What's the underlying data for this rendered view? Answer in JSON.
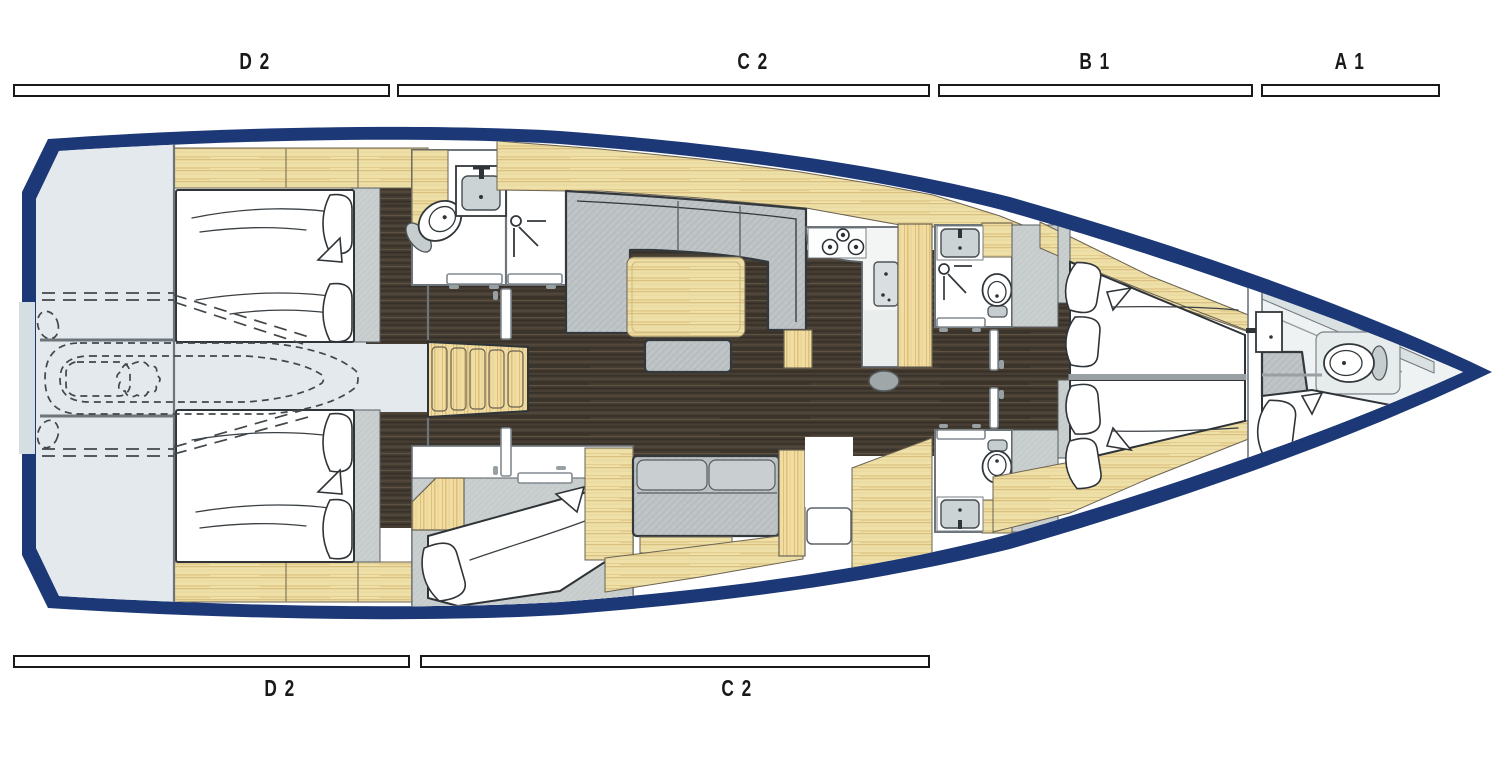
{
  "diagram_type": "sailing-yacht interior deck plan, top view",
  "zones": {
    "top": [
      {
        "id": "D2",
        "label": "D 2"
      },
      {
        "id": "C2",
        "label": "C 2"
      },
      {
        "id": "B1",
        "label": "B 1"
      },
      {
        "id": "A1",
        "label": "A 1"
      }
    ],
    "bottom": [
      {
        "id": "D2",
        "label": "D 2"
      },
      {
        "id": "C2",
        "label": "C 2"
      }
    ]
  },
  "fixtures_visible": [
    "double-bed",
    "v-berth",
    "single-berth",
    "pillows",
    "toilet",
    "washbasin",
    "shower-head",
    "stove-burners",
    "companionway-stairs",
    "saloon-sofa",
    "saloon-table",
    "ottoman",
    "settee",
    "wardrobe-cabinetry",
    "dashed-dinghy-stowage",
    "swim-platform"
  ],
  "colors": {
    "hull_navy": "#1c3876",
    "wood_light": "#efe0a8",
    "wood_grain": "#d9c182",
    "wood_accent": "#f1dca2",
    "floor_dark": "#463e33",
    "upholstery_gray": "#bec3c5",
    "bedframe_gray": "#c9cfcf",
    "platform_gray": "#e3e9ec",
    "bow_interior": "#eef2f2",
    "wall_gray": "#6d757b",
    "outline_dark": "#2f3438",
    "label_black": "#17191b"
  }
}
